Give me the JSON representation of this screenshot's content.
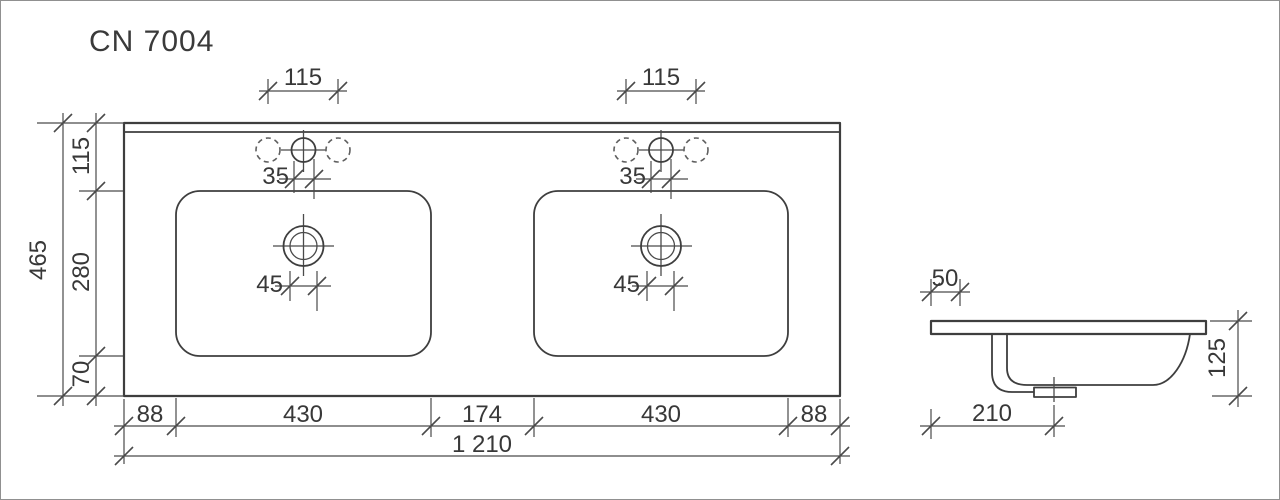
{
  "title": "CN 7004",
  "drawing": {
    "kind": "technical dimension drawing",
    "subject": "double washbasin countertop",
    "views": [
      "top view",
      "side section view"
    ],
    "units": "mm"
  },
  "top_view": {
    "overall_width": "1 210",
    "overall_depth": "465",
    "width_segments": [
      "88",
      "430",
      "174",
      "430",
      "88"
    ],
    "depth_segments": [
      "115",
      "280",
      "70"
    ],
    "faucet_hole_pitch": "115",
    "faucet_hole_offset": "35",
    "drain_hole_diameter": "45"
  },
  "side_view": {
    "front_edge_offset": "50",
    "bowl_height": "125",
    "drain_center_from_front": "210"
  },
  "labels": {
    "title": "CN 7004",
    "faucet_pitch_left": "115",
    "faucet_pitch_right": "115",
    "faucet_offset_left": "35",
    "faucet_offset_right": "35",
    "drain_dia_left": "45",
    "drain_dia_right": "45",
    "depth_total": "465",
    "depth_seg_top": "115",
    "depth_seg_mid": "280",
    "depth_seg_bottom": "70",
    "width_seg_1": "88",
    "width_seg_2": "430",
    "width_seg_3": "174",
    "width_seg_4": "430",
    "width_seg_5": "88",
    "width_total": "1 210",
    "side_offset": "50",
    "side_height": "125",
    "side_drain": "210"
  },
  "colors": {
    "background": "#ffffff",
    "line": "#3e3e3e",
    "dimension_line": "#4a4a4a",
    "text": "#383838",
    "border": "#909090"
  }
}
